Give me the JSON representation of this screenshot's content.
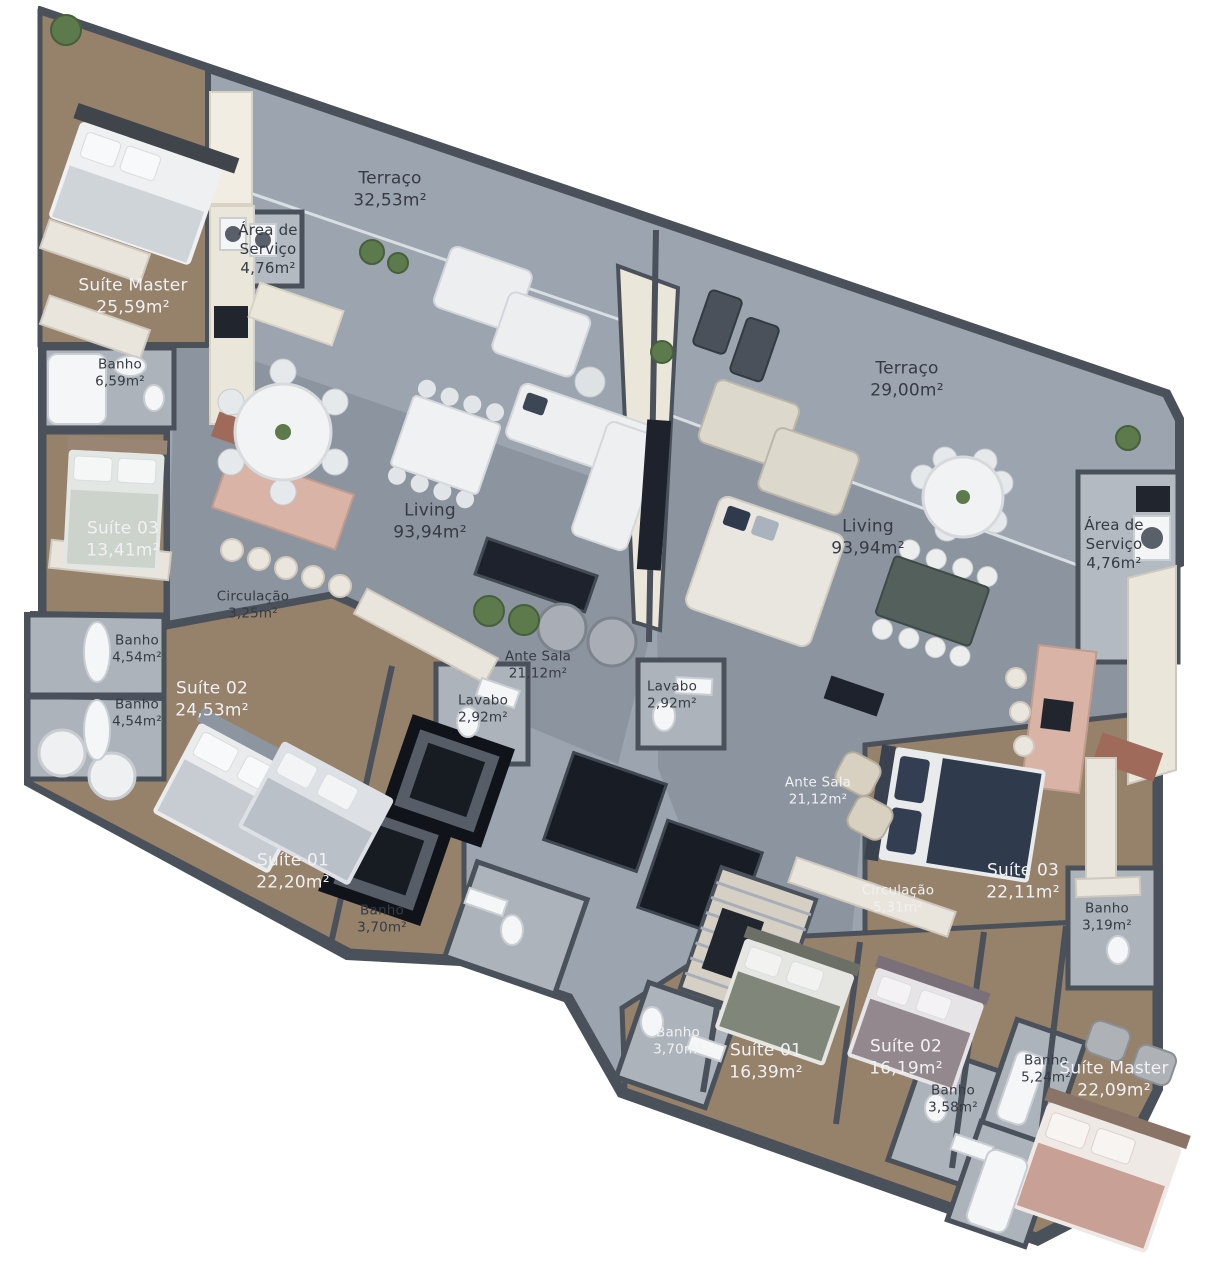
{
  "plan_title": "Floor plan - two apartment units",
  "palette": {
    "wall": "#4a515b",
    "terrace_floor": "#9ba4af",
    "living_floor": "#8c949f",
    "wood_floor": "#96816a",
    "bath_floor": "#adb3bb",
    "hall_cream": "#ebe6da",
    "counter_pink": "#d8b3a6",
    "dark_panel": "#1d222c",
    "bed_navy": "#2f3a4d",
    "bed_rose": "#c9a096",
    "plant_green": "#5d7a4c"
  },
  "units": {
    "left": {
      "terraco": {
        "name": "Terraço",
        "area": "32,53m²"
      },
      "area_servico": {
        "name": "Área de Serviço",
        "area": "4,76m²"
      },
      "suite_master": {
        "name": "Suíte Master",
        "area": "25,59m²"
      },
      "banho_master": {
        "name": "Banho",
        "area": "6,59m²"
      },
      "suite_03": {
        "name": "Suíte 03",
        "area": "13,41m²"
      },
      "banho_1": {
        "name": "Banho",
        "area": "4,54m²"
      },
      "banho_2": {
        "name": "Banho",
        "area": "4,54m²"
      },
      "suite_02": {
        "name": "Suíte 02",
        "area": "24,53m²"
      },
      "circulacao": {
        "name": "Circulação",
        "area": "3,25m²"
      },
      "living": {
        "name": "Living",
        "area": "93,94m²"
      },
      "ante_sala": {
        "name": "Ante Sala",
        "area": "21,12m²"
      },
      "lavabo": {
        "name": "Lavabo",
        "area": "2,92m²"
      },
      "suite_01": {
        "name": "Suíte 01",
        "area": "22,20m²"
      },
      "banho_suite01": {
        "name": "Banho",
        "area": "3,70m²"
      }
    },
    "right": {
      "terraco": {
        "name": "Terraço",
        "area": "29,00m²"
      },
      "living": {
        "name": "Living",
        "area": "93,94m²"
      },
      "area_servico": {
        "name": "Área de Serviço",
        "area": "4,76m²"
      },
      "lavabo": {
        "name": "Lavabo",
        "area": "2,92m²"
      },
      "ante_sala": {
        "name": "Ante Sala",
        "area": "21,12m²"
      },
      "suite_03": {
        "name": "Suíte 03",
        "area": "22,11m²"
      },
      "circulacao": {
        "name": "Circulação",
        "area": "5,31m²"
      },
      "banho_suite03": {
        "name": "Banho",
        "area": "3,19m²"
      },
      "banho_suite01": {
        "name": "Banho",
        "area": "3,70m²"
      },
      "suite_01": {
        "name": "Suíte 01",
        "area": "16,39m²"
      },
      "suite_02": {
        "name": "Suíte 02",
        "area": "16,19m²"
      },
      "banho_suite02": {
        "name": "Banho",
        "area": "3,58m²"
      },
      "banho_master": {
        "name": "Banho",
        "area": "5,24m²"
      },
      "suite_master": {
        "name": "Suíte Master",
        "area": "22,09m²"
      }
    }
  }
}
